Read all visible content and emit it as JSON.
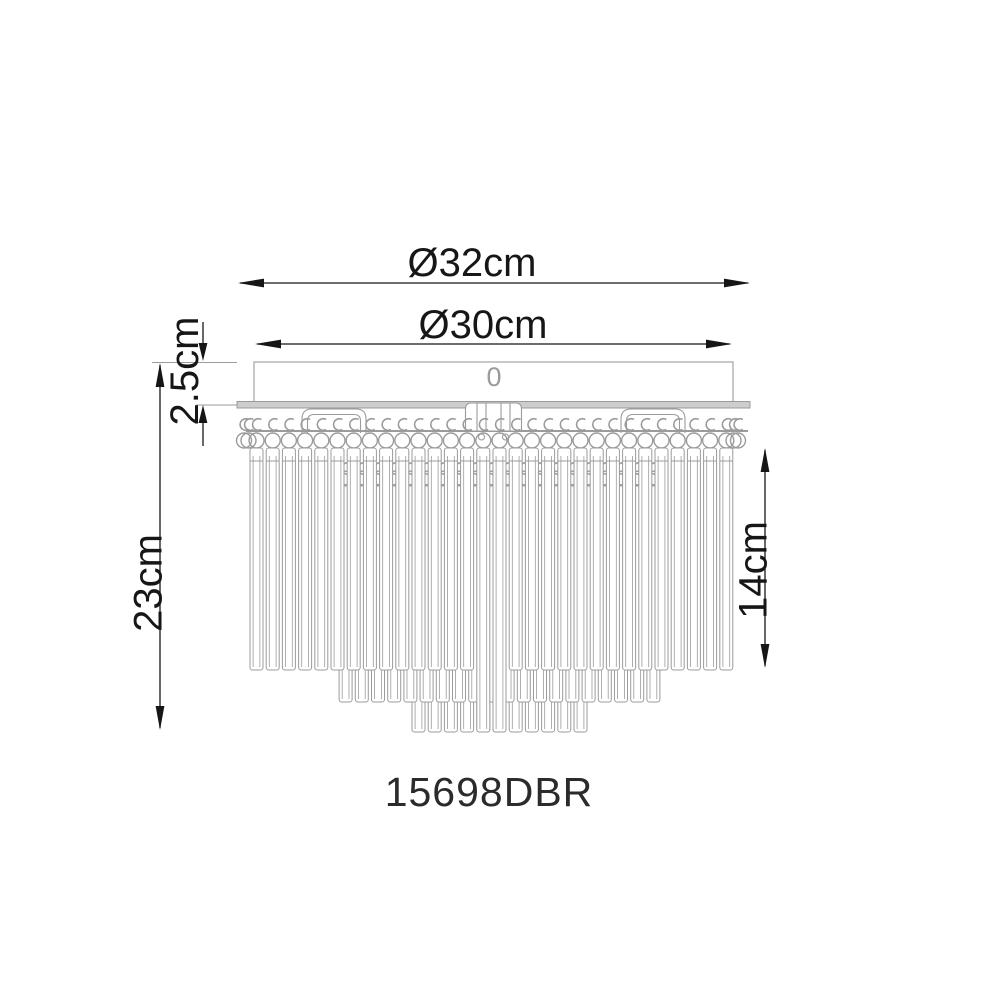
{
  "drawing": {
    "model_number": "15698DBR",
    "canopy_mark": "0",
    "dimensions": {
      "outer_diameter": "Ø32cm",
      "inner_diameter": "Ø30cm",
      "canopy_height": "2.5cm",
      "total_height": "23cm",
      "crystal_drop": "14cm"
    },
    "colors": {
      "line": "#9b9b9b",
      "dimension": "#161616",
      "plate_fill": "#cdcdcd",
      "background": "#ffffff"
    }
  }
}
